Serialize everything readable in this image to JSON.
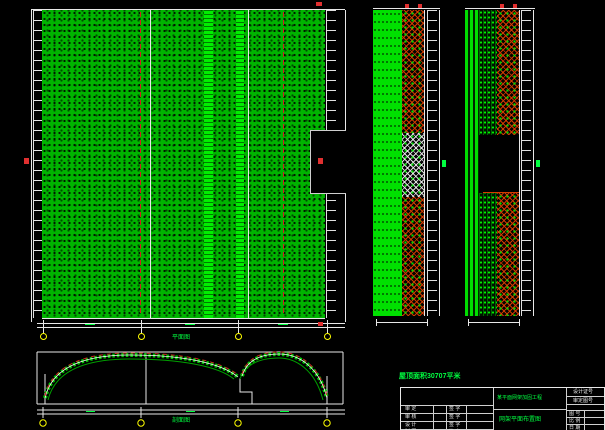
{
  "drawing": {
    "note": "屋顶面积30707平米",
    "plan_label": "平面图",
    "section_label": "剖面图"
  },
  "title_block": {
    "project_name": "某平面网架加固工程",
    "drawing_name": "网架平面布置图",
    "cert_label": "设计证号",
    "approval_label": "审定图号",
    "left_rows": [
      {
        "role": "审 定",
        "sign": "签 字"
      },
      {
        "role": "审 核",
        "sign": "签 字"
      },
      {
        "role": "设 计",
        "sign": "签 字"
      },
      {
        "role": "制 图",
        "sign": "签 字"
      }
    ],
    "right_rows": [
      "图 号",
      "比 例",
      "日 期"
    ]
  },
  "colors": {
    "background": "#000000",
    "hatch_green": "#00b400",
    "bright_green": "#00ff00",
    "lattice_red": "#d73c00",
    "line_white": "#e8e8e8",
    "axis_yellow": "#ffff00",
    "marker_red": "#e03030"
  }
}
